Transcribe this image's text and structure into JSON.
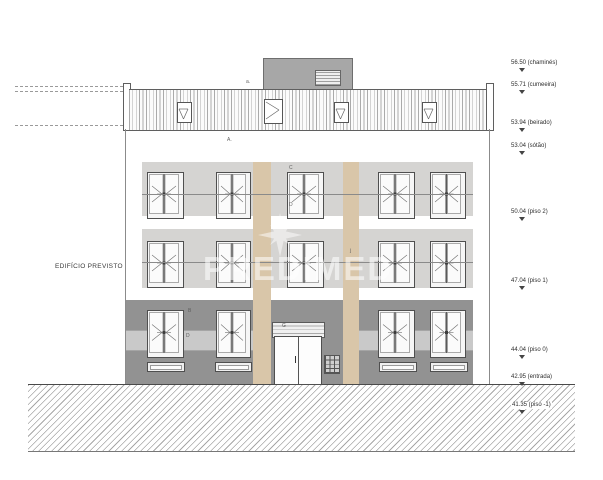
{
  "drawing": {
    "title_label": "EDIFÍCIO PREVISTO",
    "watermark": "PREDIMED",
    "levels": [
      {
        "label": "56.50 (chaminés)"
      },
      {
        "label": "55.71 (cumeeira)"
      },
      {
        "label": "53.94 (beirado)"
      },
      {
        "label": "53.04 (sótão)"
      },
      {
        "label": "50.04 (piso 2)"
      },
      {
        "label": "47.04 (piso 1)"
      },
      {
        "label": "44.04 (piso 0)"
      },
      {
        "label": "42.95 (entrada)"
      },
      {
        "label": "41.35 (piso -1)"
      }
    ],
    "annotations": {
      "roof": "a.",
      "attic": "A.",
      "center_window_top": "C",
      "center_window_bottom": "D",
      "floor1_mark": "j",
      "ground_b": "B",
      "ground_d": "D",
      "entrance_g": "G"
    },
    "colors": {
      "facade_light": "#d5d4d2",
      "facade_dark": "#929292",
      "pilaster_tan": "#d9c6a9",
      "chimney_gray": "#a7a7a7"
    }
  }
}
